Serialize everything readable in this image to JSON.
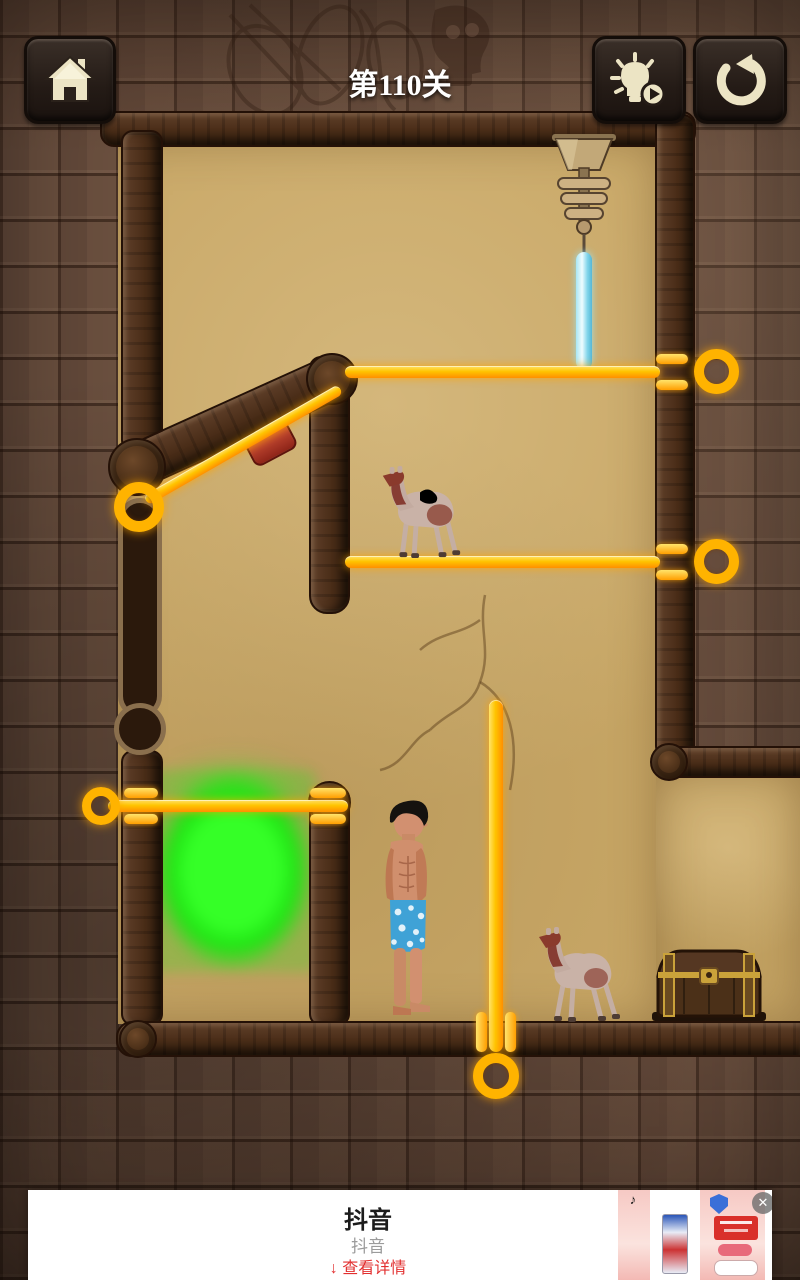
{
  "hud": {
    "title": "第110关",
    "level": "110",
    "buttons": [
      {
        "name": "home-button",
        "icon": "home-icon"
      },
      {
        "name": "hint-button",
        "icon": "lightbulb-play-icon"
      },
      {
        "name": "restart-button",
        "icon": "restart-arrow-icon"
      }
    ]
  },
  "game": {
    "objects": [
      "hanging-cutter-device",
      "ice-beam",
      "upper-camel",
      "lower-camel",
      "hero-man",
      "acid-pool",
      "treasure-chest",
      "pendulum-slot",
      "pin-top",
      "pin-camel-platform",
      "pin-diagonal",
      "pin-acid-gate",
      "pin-floor"
    ],
    "colors": {
      "pin": "#ffb300",
      "pin_glow": "#ff8f00",
      "acid_green": "#22e418",
      "icicle_blue": "#8fdef2",
      "sand": "#c8a766",
      "wood": "#4a2d18",
      "stone": "#63493a"
    }
  },
  "ad": {
    "app_name": "抖音",
    "subtitle": "抖音",
    "cta_arrow": "↓",
    "cta_label": "查看详情",
    "cta_color": "#e23030"
  },
  "icons": {
    "close": "✕",
    "music_note": "♪"
  }
}
